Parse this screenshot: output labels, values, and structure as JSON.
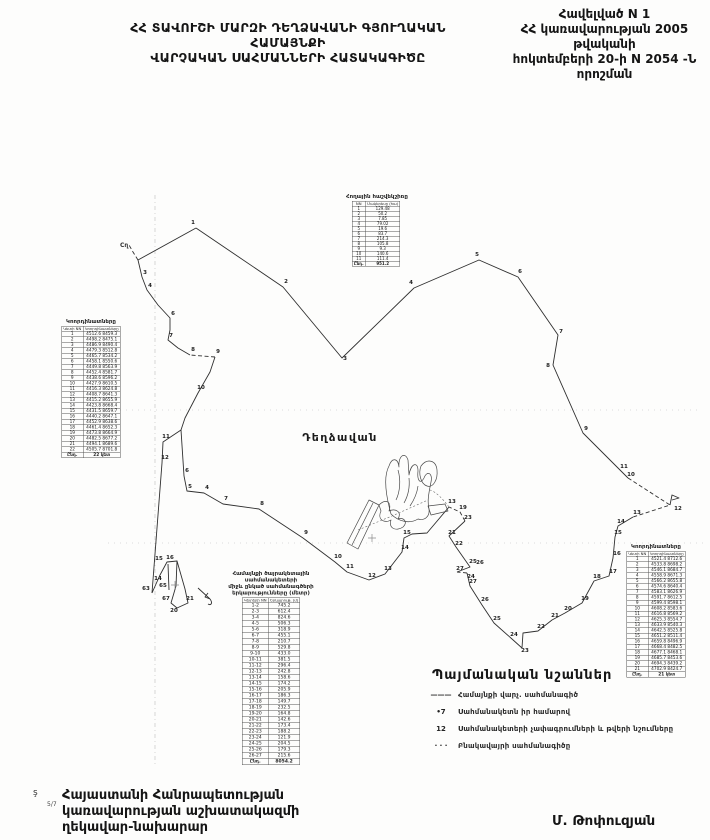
{
  "header": {
    "title_line1": "ՀՀ ՏԱՎՈՒՇԻ ՄԱՐԶԻ ԴԵՂՁԱՎԱՆԻ ԳՅՈՒՂԱԿԱՆ ՀԱՄԱՅՆՔԻ",
    "title_line2": "ՎԱՐՉԱԿԱՆ ՍԱՀՄԱՆՆԵՐԻ ՀԱՏԱԿԱԳԻԾԸ",
    "annex_line1": "Հավելված N 1",
    "annex_line2": "ՀՀ կառավարության 2005 թվականի",
    "annex_line3": "հոկտեմբերի 20-ի N 2054 -Ն որոշման"
  },
  "map": {
    "settlement_label": "Դեղձավան",
    "corner_mark": "Cղ",
    "points": [
      [
        193,
        224,
        "1"
      ],
      [
        286,
        283,
        "2"
      ],
      [
        345,
        360,
        "3"
      ],
      [
        411,
        284,
        "4"
      ],
      [
        477,
        256,
        "5"
      ],
      [
        520,
        273,
        "6"
      ],
      [
        561,
        333,
        "7"
      ],
      [
        548,
        367,
        "8"
      ],
      [
        586,
        430,
        "9"
      ],
      [
        631,
        476,
        "10"
      ],
      [
        624,
        468,
        "11"
      ],
      [
        678,
        510,
        "12"
      ],
      [
        637,
        514,
        "13"
      ],
      [
        621,
        523,
        "14"
      ],
      [
        618,
        534,
        "15"
      ],
      [
        617,
        555,
        "16"
      ],
      [
        613,
        573,
        "17"
      ],
      [
        597,
        578,
        "18"
      ],
      [
        585,
        600,
        "19"
      ],
      [
        568,
        610,
        "20"
      ],
      [
        555,
        617,
        "21"
      ],
      [
        541,
        628,
        "22"
      ],
      [
        525,
        652,
        "23"
      ],
      [
        514,
        636,
        "24"
      ],
      [
        497,
        620,
        "25"
      ],
      [
        485,
        601,
        "26"
      ],
      [
        473,
        583,
        "27"
      ],
      [
        452,
        503,
        "13"
      ],
      [
        463,
        509,
        "19"
      ],
      [
        468,
        519,
        "23"
      ],
      [
        452,
        534,
        "21"
      ],
      [
        459,
        545,
        "22"
      ],
      [
        473,
        563,
        "25"
      ],
      [
        480,
        564,
        "26"
      ],
      [
        460,
        570,
        "27"
      ],
      [
        471,
        578,
        "24"
      ],
      [
        262,
        505,
        "8"
      ],
      [
        226,
        500,
        "7"
      ],
      [
        207,
        489,
        "4"
      ],
      [
        190,
        488,
        "5"
      ],
      [
        187,
        472,
        "6"
      ],
      [
        306,
        534,
        "9"
      ],
      [
        338,
        558,
        "10"
      ],
      [
        350,
        568,
        "11"
      ],
      [
        372,
        577,
        "12"
      ],
      [
        388,
        570,
        "13"
      ],
      [
        405,
        549,
        "14"
      ],
      [
        407,
        534,
        "15"
      ],
      [
        145,
        274,
        "3"
      ],
      [
        150,
        287,
        "4"
      ],
      [
        173,
        315,
        "6"
      ],
      [
        171,
        337,
        "7"
      ],
      [
        193,
        351,
        "8"
      ],
      [
        218,
        353,
        "9"
      ],
      [
        201,
        389,
        "10"
      ],
      [
        166,
        438,
        "11"
      ],
      [
        165,
        459,
        "12"
      ],
      [
        146,
        590,
        "63"
      ],
      [
        158,
        580,
        "14"
      ],
      [
        159,
        560,
        "15"
      ],
      [
        170,
        559,
        "16"
      ],
      [
        163,
        587,
        "65"
      ],
      [
        166,
        600,
        "67"
      ],
      [
        174,
        612,
        "20"
      ],
      [
        190,
        600,
        "21"
      ]
    ]
  },
  "tables": {
    "landuse": {
      "title": "Հողային հաշվեկշիռը",
      "col1": "NN",
      "col2": "Մակերեսը (հա)",
      "rows": [
        [
          "1",
          "129.48"
        ],
        [
          "2",
          "50.2"
        ],
        [
          "3",
          "7.85"
        ],
        [
          "4",
          "79.02"
        ],
        [
          "5",
          "19.6"
        ],
        [
          "6",
          "83.7"
        ],
        [
          "7",
          "214.3"
        ],
        [
          "8",
          "105.8"
        ],
        [
          "9",
          "9.3"
        ],
        [
          "10",
          "140.6"
        ],
        [
          "11",
          "111.4"
        ]
      ],
      "total_label": "Ընդ.",
      "total_value": "951.2"
    },
    "coords_left": {
      "title": "Կոորդինատները",
      "col1": "Կետի NN",
      "col2": "Կոորդինատները",
      "rows": [
        [
          "1",
          "4512.6  8459.3"
        ],
        [
          "2",
          "4498.2  8475.1"
        ],
        [
          "3",
          "4486.9  8490.4"
        ],
        [
          "4",
          "4479.3  8512.8"
        ],
        [
          "5",
          "4465.7  8534.2"
        ],
        [
          "6",
          "4458.1  8550.6"
        ],
        [
          "7",
          "4449.8  8563.9"
        ],
        [
          "8",
          "4452.4  8581.7"
        ],
        [
          "9",
          "4438.6  8596.2"
        ],
        [
          "10",
          "4427.9  8610.5"
        ],
        [
          "11",
          "4416.3  8624.8"
        ],
        [
          "12",
          "4408.7  8641.3"
        ],
        [
          "13",
          "4415.2  8655.9"
        ],
        [
          "14",
          "4423.8  8668.4"
        ],
        [
          "15",
          "4431.5  8659.7"
        ],
        [
          "16",
          "4440.2  8647.1"
        ],
        [
          "17",
          "4452.9  8638.6"
        ],
        [
          "18",
          "4461.4  8652.3"
        ],
        [
          "19",
          "4473.8  8664.9"
        ],
        [
          "20",
          "4482.5  8677.2"
        ],
        [
          "21",
          "4494.1  8689.6"
        ],
        [
          "22",
          "4505.7  8701.8"
        ]
      ],
      "total_label": "Ընդ.",
      "total_value": "22 կետ"
    },
    "segments": {
      "title_line1": "Համայնքի ծայրակետային սահմանակետերի",
      "title_line2": "միջև ընկած սահմանագծերի",
      "title_line3": "երկարությունները (մետր)",
      "col1": "Կետերի NN",
      "col2": "Երկարութ. (մ)",
      "rows": [
        [
          "1-2",
          "745.2"
        ],
        [
          "2-3",
          "612.4"
        ],
        [
          "3-4",
          "824.6"
        ],
        [
          "4-5",
          "506.3"
        ],
        [
          "5-6",
          "318.9"
        ],
        [
          "6-7",
          "455.1"
        ],
        [
          "7-8",
          "210.7"
        ],
        [
          "8-9",
          "529.8"
        ],
        [
          "9-10",
          "433.0"
        ],
        [
          "10-11",
          "381.5"
        ],
        [
          "11-12",
          "296.4"
        ],
        [
          "12-13",
          "242.8"
        ],
        [
          "13-14",
          "158.6"
        ],
        [
          "14-15",
          "174.2"
        ],
        [
          "15-16",
          "205.9"
        ],
        [
          "16-17",
          "186.3"
        ],
        [
          "17-18",
          "149.7"
        ],
        [
          "18-19",
          "232.5"
        ],
        [
          "19-20",
          "164.8"
        ],
        [
          "20-21",
          "142.6"
        ],
        [
          "21-22",
          "173.4"
        ],
        [
          "22-23",
          "188.2"
        ],
        [
          "23-24",
          "121.9"
        ],
        [
          "24-25",
          "204.5"
        ],
        [
          "25-26",
          "179.3"
        ],
        [
          "26-27",
          "215.6"
        ]
      ],
      "total_label": "Ընդ.",
      "total_value": "8054.2"
    },
    "coords_right": {
      "title": "Կոորդինատները",
      "col1": "Կետի NN",
      "col2": "Կոորդինատները",
      "rows": [
        [
          "1",
          "4521.4  8712.6"
        ],
        [
          "2",
          "4533.8  8698.2"
        ],
        [
          "3",
          "4546.1  8684.7"
        ],
        [
          "4",
          "4558.9  8671.3"
        ],
        [
          "5",
          "4566.2  8655.8"
        ],
        [
          "6",
          "4574.6  8640.4"
        ],
        [
          "7",
          "4583.1  8626.9"
        ],
        [
          "8",
          "4591.7  8612.5"
        ],
        [
          "9",
          "4599.4  8598.1"
        ],
        [
          "10",
          "4608.2  8583.6"
        ],
        [
          "11",
          "4616.8  8569.2"
        ],
        [
          "12",
          "4625.3  8554.7"
        ],
        [
          "13",
          "4633.9  8540.3"
        ],
        [
          "14",
          "4642.5  8525.8"
        ],
        [
          "15",
          "4651.2  8511.4"
        ],
        [
          "16",
          "4659.8  8496.9"
        ],
        [
          "17",
          "4668.4  8482.5"
        ],
        [
          "18",
          "4677.1  8468.1"
        ],
        [
          "19",
          "4685.7  8453.6"
        ],
        [
          "20",
          "4694.3  8439.2"
        ],
        [
          "21",
          "4702.9  8424.7"
        ]
      ],
      "total_label": "Ընդ.",
      "total_value": "21 կետ"
    }
  },
  "legend": {
    "title": "Պայմանական նշաններ",
    "items": [
      {
        "symbol": "———",
        "label": "Համայնքի վարչ. սահմանագիծ"
      },
      {
        "symbol": "•7",
        "label": "Սահմանակետն իր համարով"
      },
      {
        "symbol": "12",
        "label": "Սահմանակետերի չափագրումների և թվերի նշումները"
      },
      {
        "symbol": "· · ·",
        "label": "Բնակավայրի սահմանագիծը"
      }
    ]
  },
  "footer": {
    "sig_line1": "Հայաստանի Հանրապետության",
    "sig_line2": "կառավարության աշխատակազմի",
    "sig_line3": "ղեկավար-նախարար",
    "name": "Մ. Թոփուզյան",
    "corner_mark": "ş",
    "page_mark": "5/7"
  }
}
